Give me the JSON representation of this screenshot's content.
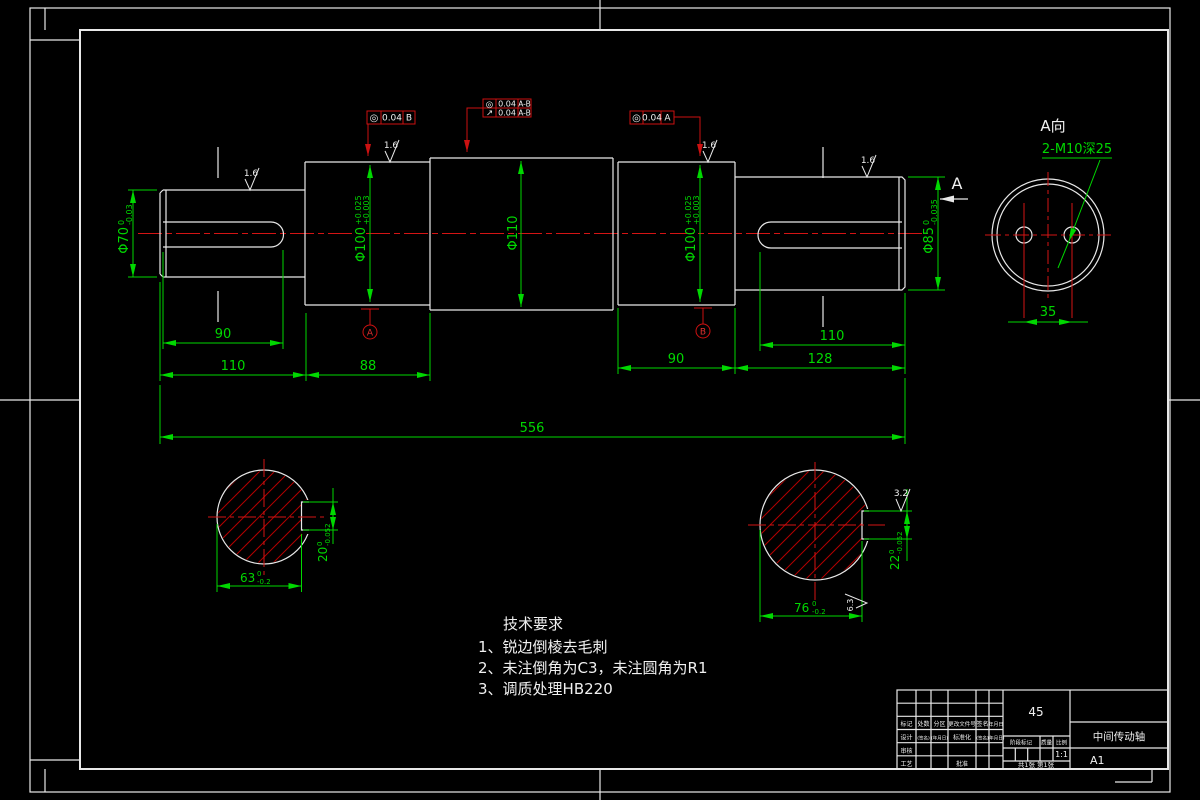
{
  "frame": {
    "view_a_title": "A向",
    "view_dir_label": "A"
  },
  "dims": {
    "d70": {
      "m": "Φ70",
      "sup": "0",
      "sub": "-0.03"
    },
    "d100L": {
      "m": "Φ100",
      "sup": "+0.025",
      "sub": "+0.003"
    },
    "d110": {
      "m": "Φ110"
    },
    "d100R": {
      "m": "Φ100",
      "sup": "+0.025",
      "sub": "+0.003"
    },
    "d85": {
      "m": "Φ85",
      "sup": "0",
      "sub": "-0.035"
    },
    "kw_len_L": "90",
    "seg1_len": "110",
    "seg2_len": "88",
    "seg4_len": "90",
    "kw_len_R": "110",
    "seg5_len": "128",
    "total_len": "556",
    "hole_span": "35",
    "holes_note": "2-M10深25"
  },
  "sections": {
    "left": {
      "width": "63",
      "width_sup": "0",
      "width_sub": "-0.2",
      "key": "20",
      "key_sup": "0",
      "key_sub": "-0.052"
    },
    "right": {
      "width": "76",
      "width_sup": "0",
      "width_sub": "-0.2",
      "key": "22",
      "key_sup": "0",
      "key_sub": "-0.052",
      "rough_top": "3.2",
      "rough_bottom": "6.3"
    }
  },
  "gdt": {
    "f1": {
      "sym": "◎",
      "val": "0.04",
      "datum": "B"
    },
    "f2a": {
      "sym": "◎",
      "val": "0.04",
      "datum": "A-B"
    },
    "f2b": {
      "sym": "↗",
      "val": "0.04",
      "datum": "A-B"
    },
    "f3": {
      "sym": "◎",
      "val": "0.04",
      "datum": "A"
    },
    "datum_a": "A",
    "datum_b": "B"
  },
  "roughness": {
    "r1": "1.6",
    "r2": "1.6",
    "r3": "1.6",
    "r4": "1.6"
  },
  "tech": {
    "title": "技术要求",
    "items": [
      "1、锐边倒棱去毛刺",
      "2、未注倒角为C3，未注圆角为R1",
      "3、调质处理HB220"
    ]
  },
  "titleblock": {
    "material": "45",
    "part_name": "中间传动轴",
    "sheet": "A1",
    "scale": "1:1",
    "sheets": "共1张 第1张",
    "labels": {
      "mark": "标记",
      "count": "处数",
      "zone": "分区",
      "doc": "更改文件号",
      "sign": "签名",
      "date": "年月日",
      "design": "设计",
      "standard": "标准化",
      "sig": "(签名)",
      "ymd": "(年月日)",
      "stage": "阶段标记",
      "weight": "质量",
      "ratio": "比例",
      "audit": "审核",
      "process": "工艺",
      "approve": "批准"
    }
  }
}
